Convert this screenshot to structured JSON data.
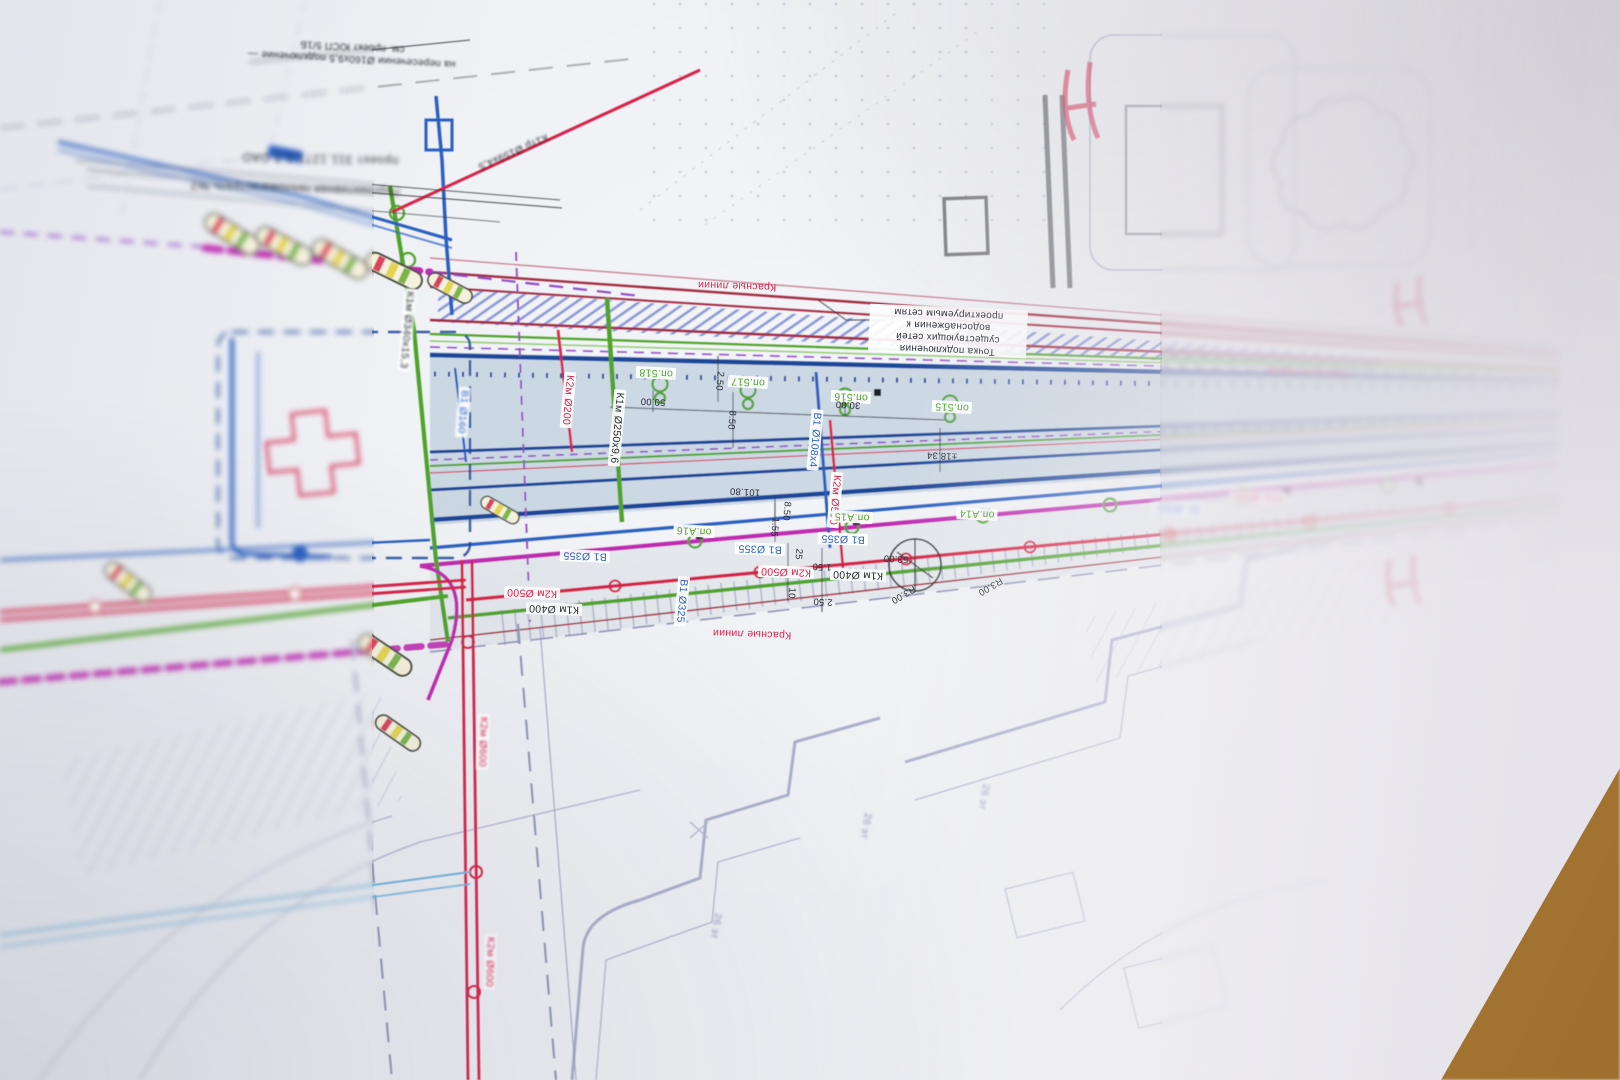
{
  "palette": {
    "paper": "#eef0f4",
    "road_fill": "#c2d1de",
    "sidewalk_fill": "#dce1e8",
    "navy": "#1d4699",
    "blue": "#2a5fc0",
    "light_blue": "#6fb4dd",
    "red": "#d6244a",
    "maroon": "#a22a40",
    "green": "#4fa32b",
    "light_green": "#8cc96c",
    "magenta": "#bf2cb0",
    "purple": "#8f4bc4",
    "building_gray": "#8d93b4",
    "ink": "#2a2d34",
    "wood": "#b5833c"
  },
  "texts": {
    "pipes": [
      "К2м Ø500",
      "К1м Ø400",
      "В1 Ø355",
      "В1 Ø355",
      "В1 Ø355",
      "В1 Ø325",
      "К2м Ø500",
      "К1м Ø400",
      "В1 Ø108х4",
      "К2м Ø500",
      "К2м Ø200",
      "К1м Ø250х9,6",
      "В1 Ø160",
      "К1м Ø340х15,3",
      "К2м Ø600",
      "К2м Ø600",
      "К1тр Ø159х4,5",
      "В1 Ø355",
      "К2м Ø500"
    ],
    "supports": [
      "оп.515",
      "оп.516",
      "оп.517",
      "оп.518",
      "оп.А14",
      "оп.А15",
      "оп.А16"
    ],
    "red_line": [
      "Красные линии",
      "Красные линии",
      "Красные линии",
      "Красные линии"
    ],
    "dims": [
      "50.00",
      "30.00",
      "2.50",
      "8.50",
      "101.80",
      "8.50",
      "1.55",
      "25",
      "1.50",
      "10",
      "2.50",
      "53.00",
      "R3.00",
      "R3.00",
      "±18.34"
    ],
    "annotations": {
      "connection_point": "Точка подключения существующих сетей водоснабжения к проектируемым сетям",
      "crossing_note": "на пересечении Ø160х9,5 подключение — см. проект ЮСП 5/1Б",
      "project_ref": "проект 311.1271.1.3 ОАО",
      "heat_main": "Перспективная тепломагистраль №2"
    },
    "buildings": [
      "26 эт",
      "26 эт",
      "26 эт"
    ]
  }
}
